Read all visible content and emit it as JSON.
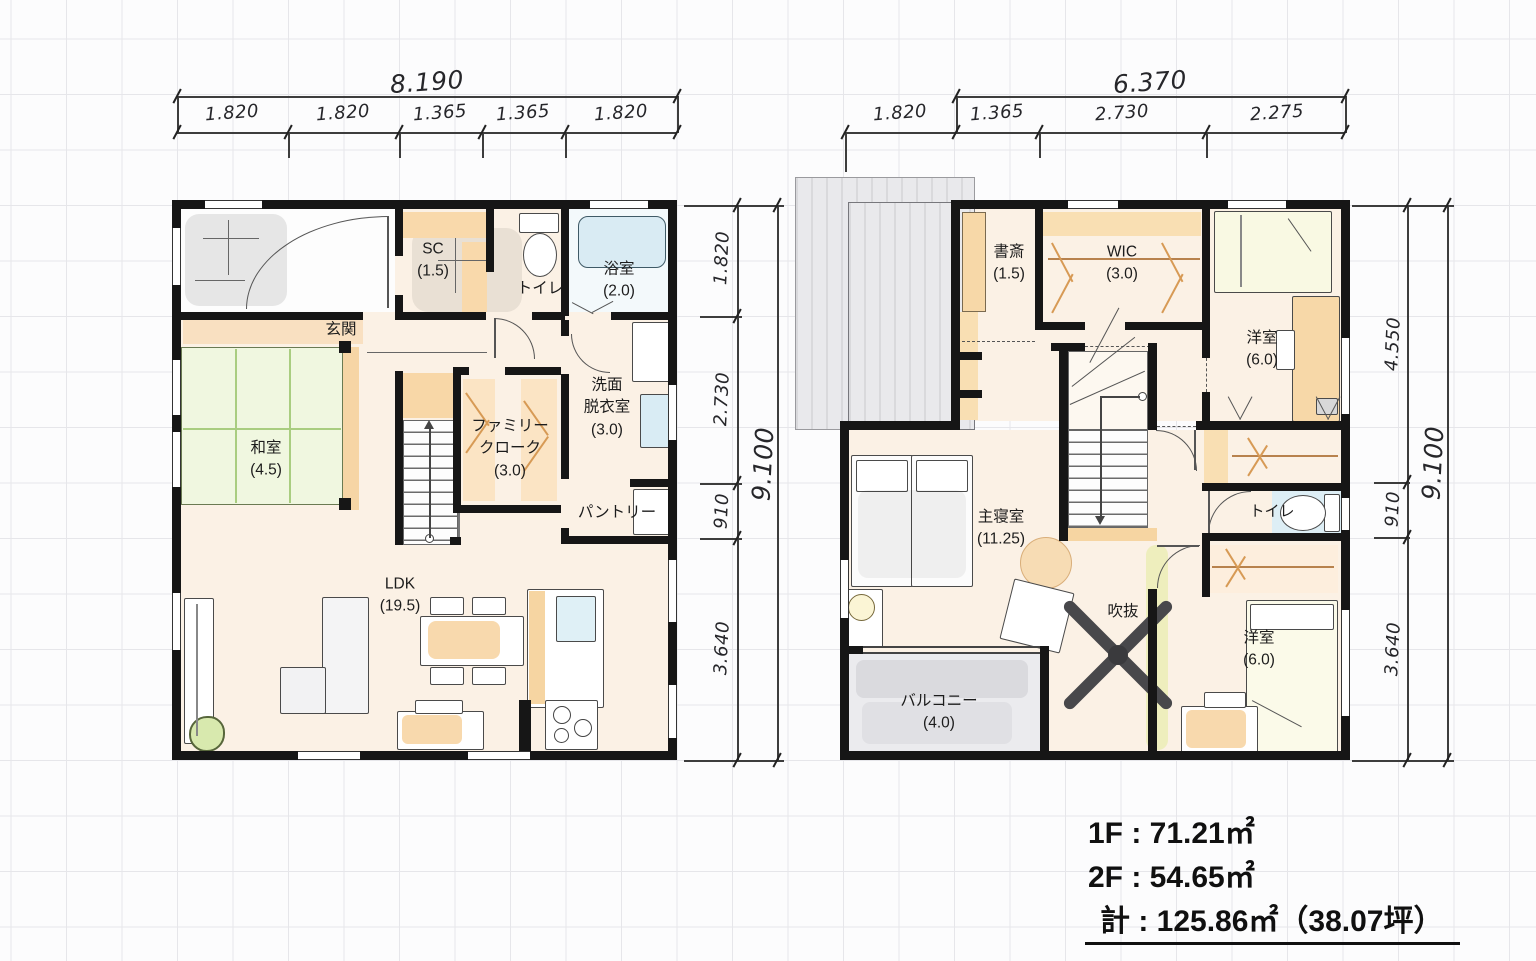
{
  "floor1": {
    "name": "1F",
    "dims": {
      "top_total": "8.190",
      "top_segments": [
        "1.820",
        "1.820",
        "1.365",
        "1.365",
        "1.820"
      ],
      "side_total": "9.100",
      "side_segments": [
        "1.820",
        "2.730",
        "910",
        "3.640"
      ]
    },
    "rooms": {
      "genkan": {
        "label": "玄関"
      },
      "sc": {
        "label": "SC",
        "size": "(1.5)"
      },
      "toilet": {
        "label": "トイレ"
      },
      "bath": {
        "label": "浴室",
        "size": "(2.0)"
      },
      "washroom": {
        "label1": "洗面",
        "label2": "脱衣室",
        "size": "(3.0)"
      },
      "washitsu": {
        "label": "和室",
        "size": "(4.5)"
      },
      "family_cloak": {
        "label1": "ファミリー",
        "label2": "クローク",
        "size": "(3.0)"
      },
      "pantry": {
        "label": "パントリー"
      },
      "ldk": {
        "label": "LDK",
        "size": "(19.5)"
      }
    }
  },
  "floor2": {
    "name": "2F",
    "dims": {
      "top_total": "6.370",
      "top_segments": [
        "1.820",
        "1.365",
        "2.730",
        "2.275"
      ],
      "side_total": "9.100",
      "side_segments": [
        "4.550",
        "910",
        "3.640"
      ]
    },
    "rooms": {
      "study": {
        "label": "書斎",
        "size": "(1.5)"
      },
      "wic": {
        "label": "WIC",
        "size": "(3.0)"
      },
      "bedroom1": {
        "label": "洋室",
        "size": "(6.0)"
      },
      "toilet": {
        "label": "トイレ"
      },
      "master": {
        "label": "主寝室",
        "size": "(11.25)"
      },
      "void": {
        "label": "吹抜"
      },
      "bedroom2": {
        "label": "洋室",
        "size": "(6.0)"
      },
      "balcony": {
        "label": "バルコニー",
        "size": "(4.0)"
      }
    }
  },
  "summary": {
    "line1": "1F : 71.21㎡",
    "line2": "2F : 54.65㎡",
    "line3": "計 : 125.86㎡（38.07坪）"
  },
  "palette": {
    "wall": "#161616",
    "floor_cream": "#fbf1e5",
    "tatami_green": "#f0f7e0",
    "wood_orange": "#f8d8a8",
    "water_blue": "#dcecf3",
    "roof_gray": "#e7e7ea",
    "highlight_yellow": "#e2eb96"
  }
}
